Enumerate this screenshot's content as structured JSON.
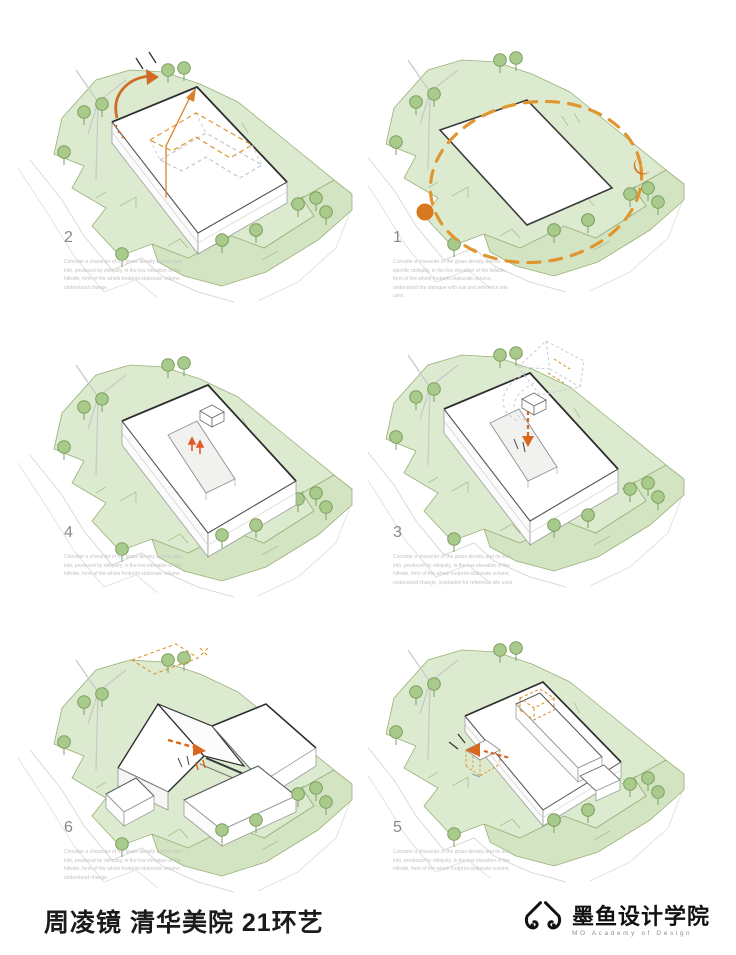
{
  "panels": [
    {
      "id": "step-2",
      "number": "2",
      "caption": "Consider a character of the grass density and its own info, produced by obliquity, in the low elevation of the hillside, form of the whole footprint elaborate volume, understand change."
    },
    {
      "id": "step-1",
      "number": "1",
      "caption": "Consider a character of the grass density and its specific obliquity, in the low elevation of the hillside, form of the whole footprint elaborate volume, understand the dialogue with sun and reference site uses."
    },
    {
      "id": "step-4",
      "number": "4",
      "caption": "Consider a character of the grass density and its own info, produced by obliquity, in the low elevation of the hillside, form of the whole footprint elaborate volume."
    },
    {
      "id": "step-3",
      "number": "3",
      "caption": "Consider a character of the grass density and its own info, produced by obliquity, in the low elevation of the hillside, form of the whole footprint elaborate volume, understand change, inspiration for reference site uses."
    },
    {
      "id": "step-6",
      "number": "6",
      "caption": "Consider a character of the grass density and its own info, produced by obliquity, in the low elevation of the hillside, form of the whole footprint elaborate volume, understand change."
    },
    {
      "id": "step-5",
      "number": "5",
      "caption": "Consider a character of the grass density and its own info, produced by obliquity, in the low elevation of the hillside, form of the whole footprint elaborate volume."
    }
  ],
  "footer": {
    "title": "周凌镜 清华美院 21环艺",
    "logo": {
      "name": "墨鱼设计学院",
      "subtitle": "MO Academy of Design",
      "icon": "squid-icon"
    }
  },
  "colors": {
    "site_green": "#dcebd0",
    "bench_green": "#d3e4c3",
    "outline_green": "#9ab077",
    "tree_fill": "#a8cb8b",
    "tree_stroke": "#7d9e5e",
    "building_edge": "#2e2e2e",
    "annotation_orange": "#d9791f",
    "dashed_orange": "#e0952f",
    "ghost_gray": "#c3ccd6",
    "number_gray": "#8a8a8a",
    "caption_gray": "#c2c2c2"
  }
}
